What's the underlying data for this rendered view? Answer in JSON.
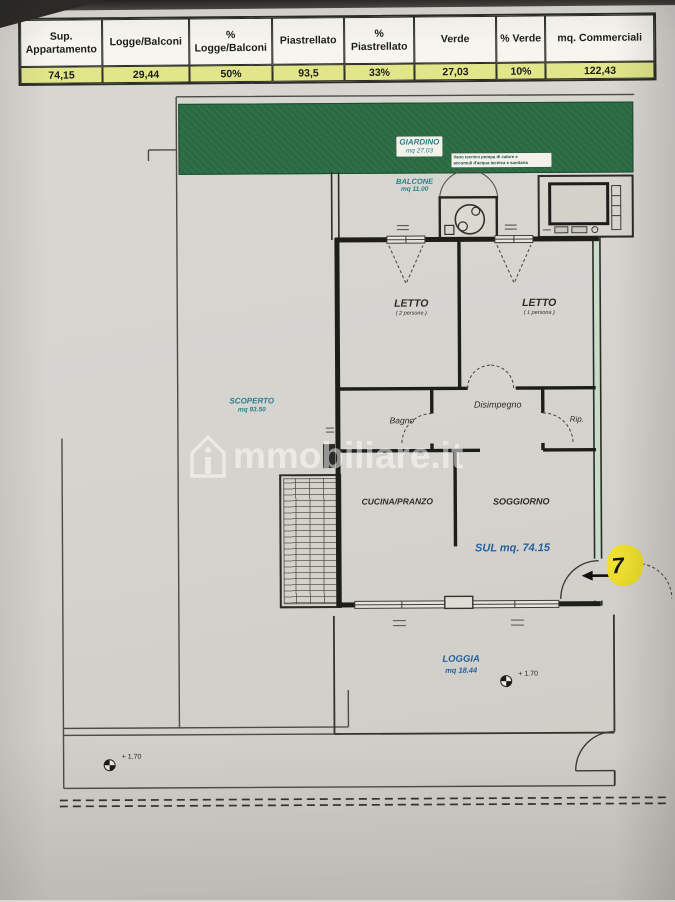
{
  "table": {
    "headers": [
      "Sup. Appartamento",
      "Logge/Balconi",
      "% Logge/Balconi",
      "Piastrellato",
      "% Piastrellato",
      "Verde",
      "% Verde",
      "mq. Commerciali"
    ],
    "values": [
      "74,15",
      "29,44",
      "50%",
      "93,5",
      "33%",
      "27,03",
      "10%",
      "122,43"
    ]
  },
  "plan": {
    "giardino": {
      "name": "GIARDINO",
      "area": "mq 27.03"
    },
    "tech_note_line1": "Vano tecnico pompa di calore e",
    "tech_note_line2": "accumuli d'acqua tecnica e sanitaria",
    "balcone": {
      "name": "BALCONE",
      "area": "mq 11.00"
    },
    "letto_matrimoniale": {
      "name": "LETTO",
      "sub": "( 2 persone )"
    },
    "letto_singolo": {
      "name": "LETTO",
      "sub": "( 1 persona )"
    },
    "bagno": {
      "name": "Bagno"
    },
    "disimpegno": {
      "name": "Disimpegno"
    },
    "ripostiglio": {
      "name": "Rip."
    },
    "cucina": {
      "name": "CUCINA/PRANZO"
    },
    "soggiorno": {
      "name": "SOGGIORNO"
    },
    "superficie_utile": "SUL mq. 74.15",
    "scoperto": {
      "name": "SCOPERTO",
      "area": "mq 93.50"
    },
    "loggia": {
      "name": "LOGGIA",
      "area": "mq 18.44"
    },
    "quota_loggia": "+ 1.70",
    "quota_scoperto": "+ 1.70",
    "unit_marker": "7"
  },
  "watermark": {
    "text": "mmobiliare.it"
  },
  "colors": {
    "garden": "#2a6a42",
    "teal": "#2a7f8c",
    "blue": "#25629d",
    "highlight": "#e1e68a",
    "marker": "#e8d71f"
  }
}
